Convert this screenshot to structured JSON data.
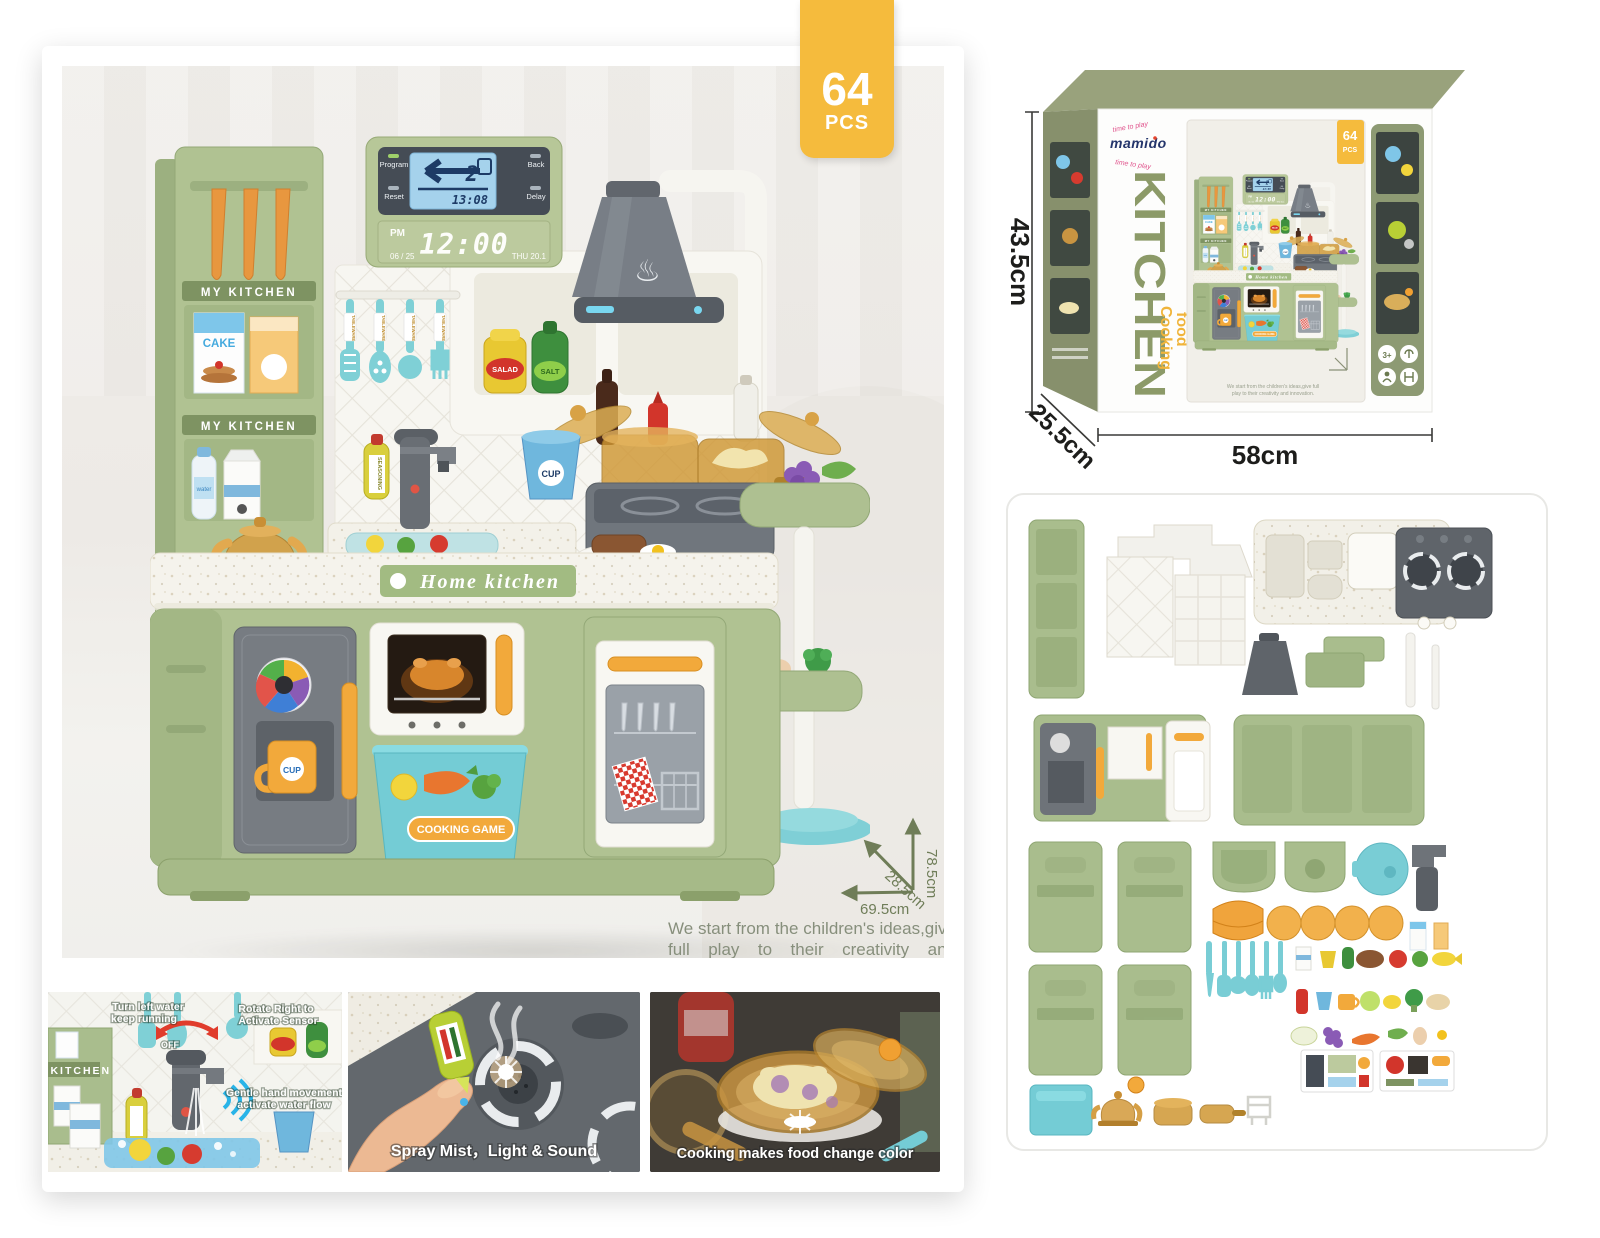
{
  "badge": {
    "count": "64",
    "unit": "PCS"
  },
  "kitchen": {
    "sign_top": "COOKING GAME",
    "shelf_label_1": "MY KITCHEN",
    "shelf_label_2": "MY KITCHEN",
    "cake": "CAKE",
    "water": "water",
    "seasoning": "SEASONING",
    "salad": "SALAD",
    "salt": "SALT",
    "tableware": "TABLEWARE",
    "cup_blue": "CUP",
    "cup_orange": "CUP",
    "counter_sign": "Home kitchen",
    "basket_label": "COOKING GAME",
    "display": {
      "program": "Program",
      "back": "Back",
      "reset": "Reset",
      "delay": "Delay",
      "value": "2",
      "sub_time": "13:08",
      "pm": "PM",
      "time": "12:00",
      "date": "06 / 25",
      "day_temp": "THU 20.1"
    }
  },
  "main_dims": {
    "height": "78.5cm",
    "depth": "28.5cm",
    "width": "69.5cm"
  },
  "caption": {
    "line1": "We start from the children's ideas,give full",
    "line2": "play to their creativity and innovation."
  },
  "box": {
    "brand": "mamido",
    "tagline_top": "time to play",
    "tagline_bottom": "time to play",
    "title": "KITCHEN",
    "subtitle_1": "Cooking",
    "subtitle_2": "food",
    "badge_count": "64",
    "badge_unit": "PCS",
    "age_rating": "3+",
    "dims": {
      "height": "43.5cm",
      "depth": "25.5cm",
      "width": "58cm"
    }
  },
  "photos": {
    "p1": {
      "label1_line1": "Turn left water",
      "label1_line2": "keep running",
      "off": "OFF",
      "label2_line1": "Rotate Right to",
      "label2_line2": "Activate Sensor",
      "label3_line1": "Gentle hand movement",
      "label3_line2": "activate water flow"
    },
    "p2": {
      "caption": "Spray Mist，Light & Sound"
    },
    "p3": {
      "caption": "Cooking makes food change color"
    }
  },
  "colors": {
    "accent_yellow": "#F5BB3D",
    "olive": "#8A9372",
    "kitchen_green": "#AFC192",
    "teal": "#79CDD5",
    "orange": "#F2A93B"
  }
}
